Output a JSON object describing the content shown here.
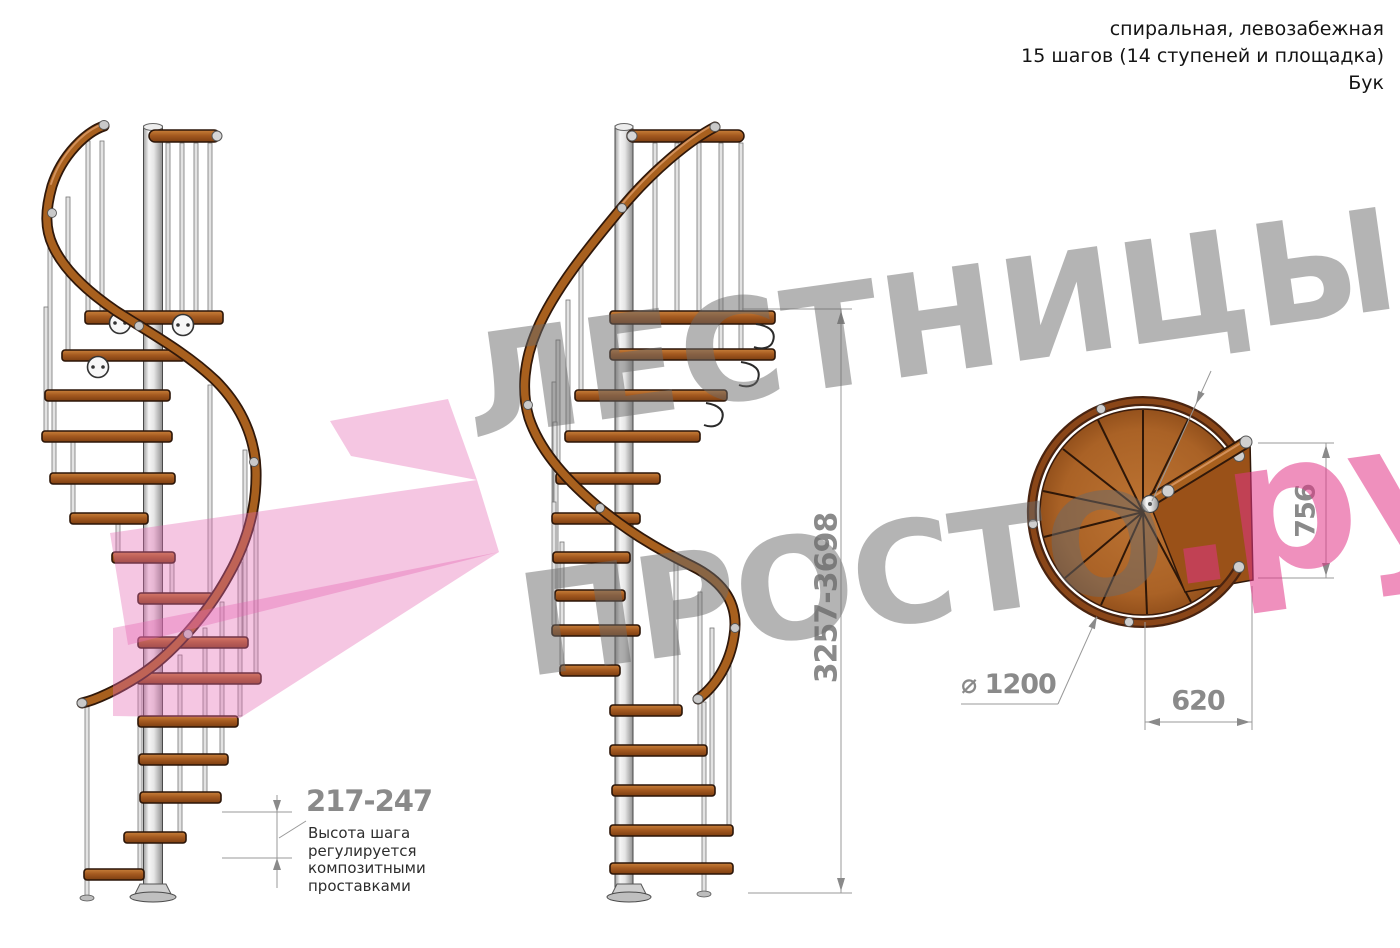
{
  "header": {
    "type_line": "спиральная, левозабежная",
    "steps_line": "15 шагов (14 ступеней и площадка)",
    "material_line": "Бук"
  },
  "dimensions": {
    "total_height_mm": "3257-3698",
    "step_height_mm": "217-247",
    "step_height_note": "Высота шага\nрегулируется\nкомпозитными\nпроставками",
    "platform_depth_mm": "756",
    "platform_width_mm": "620",
    "diameter_mm": "⌀ 1200"
  },
  "watermark": {
    "brand_top": "ЛЕСТНИЦЫ",
    "brand_bottom": "ПРОСТО",
    "brand_suffix": ".ру"
  },
  "colors": {
    "tread_wood": "#a55a20",
    "handrail_wood": "#a8601e",
    "metal_column": "#d9d9d9",
    "dimension_gray": "#8a8a8a",
    "watermark_gray": "#9b9b9b",
    "watermark_pink": "#e2509a",
    "arrow_watermark_pink": "#e668b2"
  }
}
